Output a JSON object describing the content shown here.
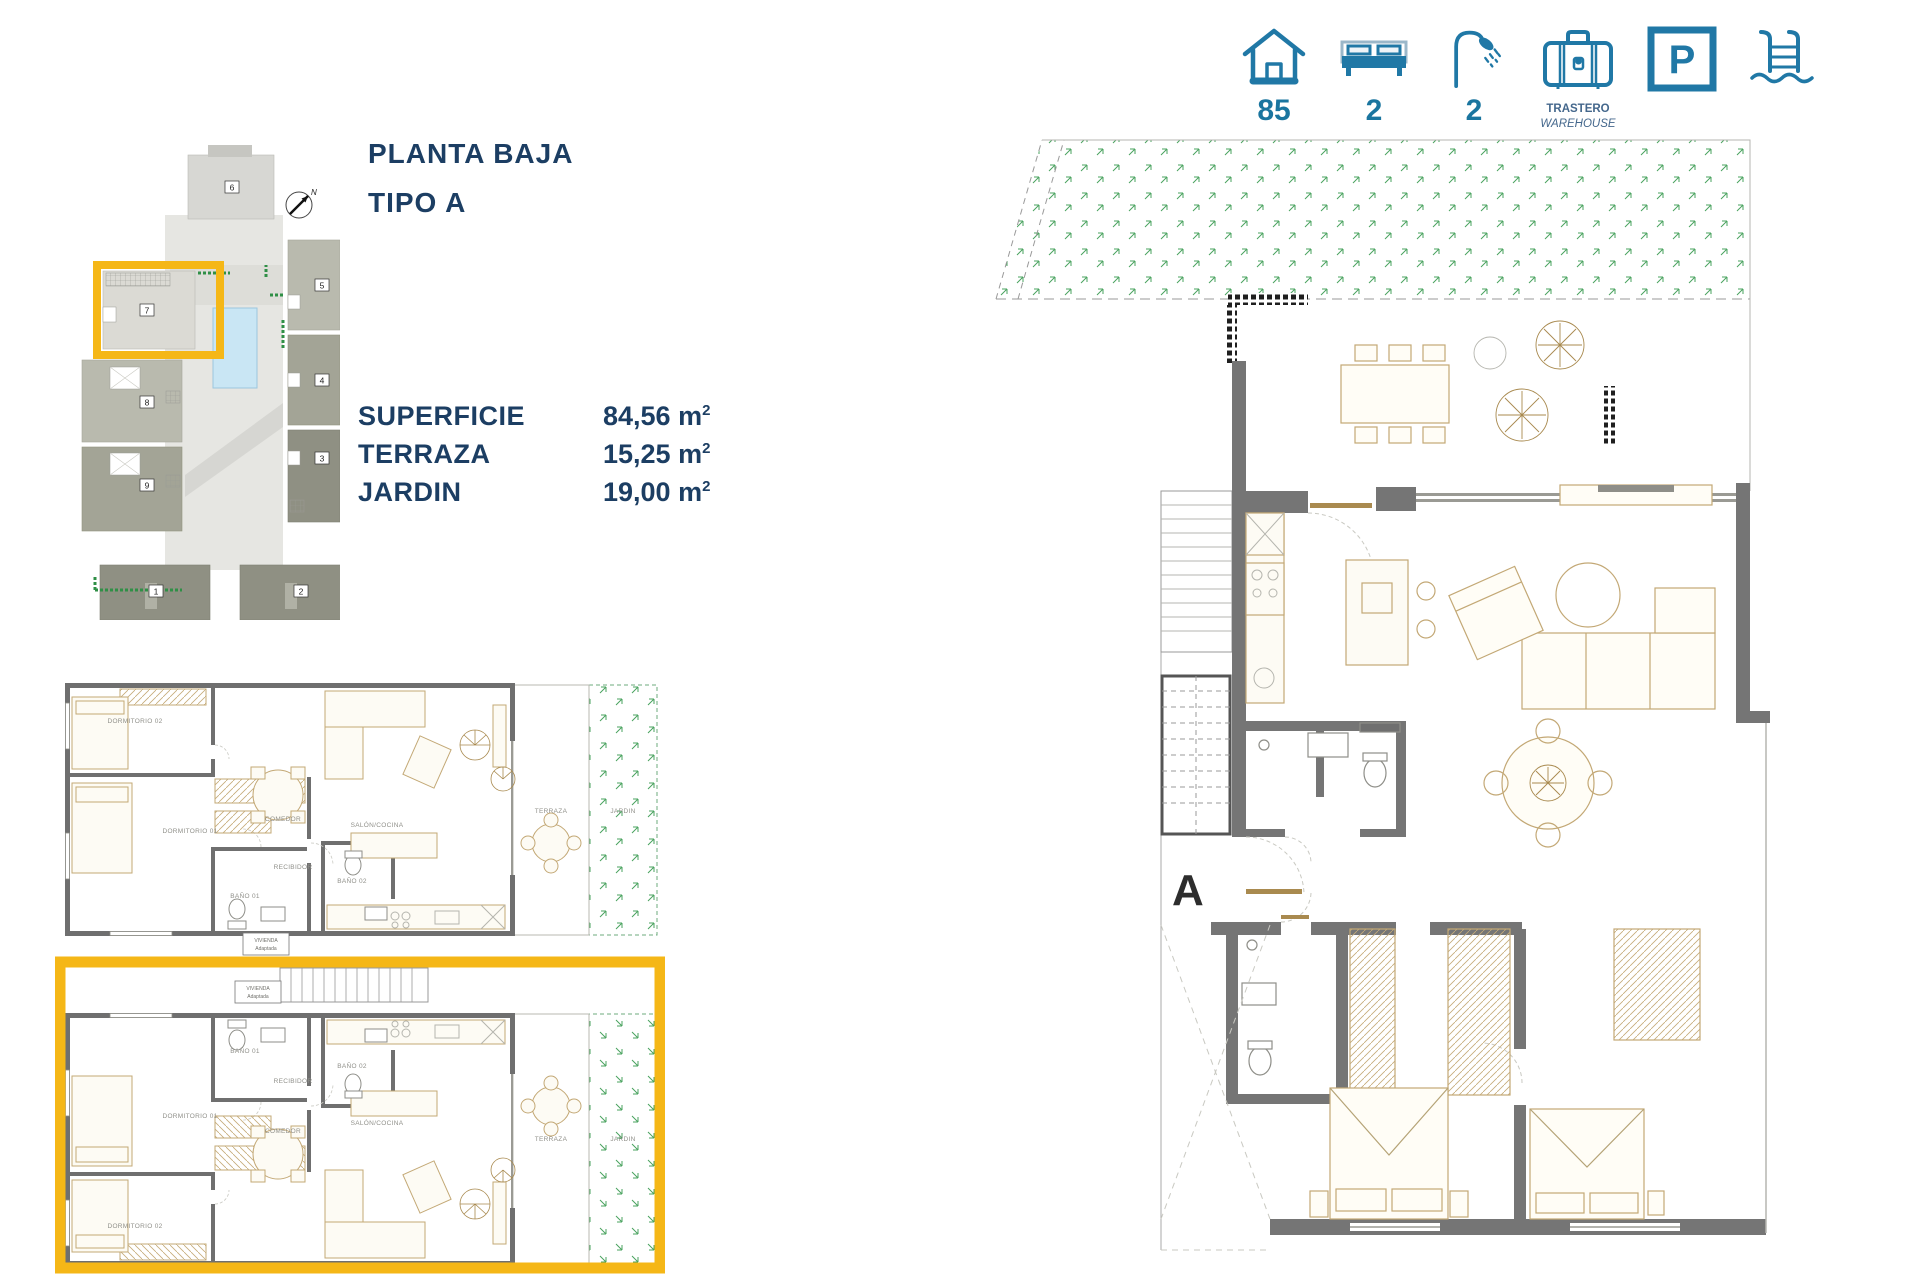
{
  "colors": {
    "accent_navy": "#1c3e63",
    "accent_teal": "#2078a6",
    "highlight_yellow": "#f5b717",
    "wall_grey": "#6f6f6f",
    "garden_green": "#4aa35f",
    "pool_blue": "#c9e6f4"
  },
  "header": {
    "house_count": "85",
    "bed_count": "2",
    "bath_count": "2",
    "storage_label_es": "TRASTERO",
    "storage_label_en": "WAREHOUSE",
    "parking_letter": "P"
  },
  "title": {
    "line1": "PLANTA BAJA",
    "line2": "TIPO A"
  },
  "specs": [
    {
      "label": "SUPERFICIE",
      "value": "84,56 m",
      "sup": "2"
    },
    {
      "label": "TERRAZA",
      "value": "15,25 m",
      "sup": "2"
    },
    {
      "label": "JARDIN",
      "value": "19,00 m",
      "sup": "2"
    }
  ],
  "site_plan": {
    "north_label": "N",
    "numbers": {
      "n1": "1",
      "n2": "2",
      "n3": "3",
      "n4": "4",
      "n5": "5",
      "n6": "6",
      "n7": "7",
      "n8": "8",
      "n9": "9"
    }
  },
  "small_plan": {
    "vivienda_line1": "VIVIENDA",
    "vivienda_line2": "Adaptada",
    "upper": {
      "dorm2": "DORMITORIO 02",
      "dorm1": "DORMITORIO 01",
      "bano1": "BAÑO 01",
      "comedor": "COMEDOR",
      "recibidor": "RECIBIDOR",
      "bano2": "BAÑO 02",
      "salon": "SALÓN/COCINA",
      "terraza": "TERRAZA",
      "jardin": "JARDIN"
    },
    "lower": {
      "dorm2": "DORMITORIO 02",
      "dorm1": "DORMITORIO 01",
      "bano1": "BAÑO 01",
      "comedor": "COMEDOR",
      "recibidor": "RECIBIDOR",
      "bano2": "BAÑO 02",
      "salon": "SALÓN/COCINA",
      "terraza": "TERRAZA",
      "jardin": "JARDIN"
    }
  },
  "large_plan": {
    "section_label": "A"
  }
}
